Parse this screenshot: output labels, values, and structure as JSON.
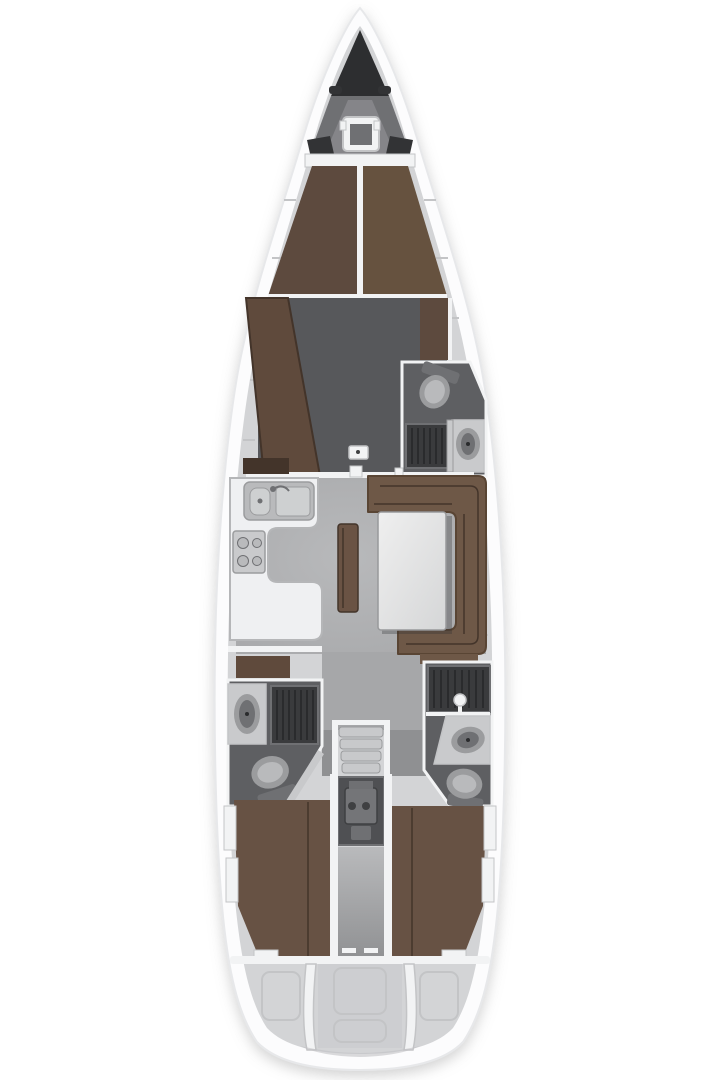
{
  "diagram": {
    "kind": "sailing-yacht-interior-floorplan",
    "orientation": "bow-up"
  },
  "colors": {
    "background": "#ffffff",
    "hull": "#fcfcfd",
    "hull_edge": "#e7e8ea",
    "liner": "#d3d4d6",
    "wall": "#f2f3f4",
    "wall_edge": "#c3c4c6",
    "anchor_locker": "#2d2e30",
    "foredeck": "#6f7073",
    "foredeck_light": "#97989b",
    "dark_locker": "#323335",
    "berth_brown": "#5d4a3e",
    "berth_brown_light": "#66523f",
    "chaise_brown": "#5f4a3c",
    "trim_brown": "#43342a",
    "sofa_brown": "#6e5847",
    "sofa_brown_dark": "#594534",
    "bench_brown": "#6a5344",
    "aft_berth_brown": "#675244",
    "floor_dark": "#57585b",
    "floor_mid": "#8f9092",
    "salon_floor": "#a6a7a9",
    "salon_floor_light": "#b8b9bb",
    "head_floor": "#5e5f62",
    "grate_dark": "#3a3b3d",
    "grate_line": "#2a2b2d",
    "fixture_lighter": "#b9babc",
    "fixture_light": "#c9cacc",
    "fixture_mid": "#9b9c9e",
    "fixture_dark": "#6f7073",
    "counter": "#eff0f2",
    "counter_edge": "#b5b6b8",
    "sink_steel": "#ced0d1",
    "table_edge": "#98999b",
    "table_light": "#efefef",
    "table_dark": "#d5d6d7",
    "stairs": "#c8c9cb",
    "stairs_edge": "#9a9b9d",
    "engine_bg": "#4f5053",
    "engine_part": "#747578",
    "engine_dark": "#3f4042",
    "stern_inner": "#cbccce",
    "stern_shade": "#c1c2c4",
    "shadow": "#2e2f31"
  },
  "components": {
    "bow": [
      "anchor-locker",
      "bow-cleats",
      "anchor-windlass"
    ],
    "forward_cabin": [
      "v-berth",
      "chaise-seat",
      "wardrobe",
      "floor-hatch"
    ],
    "forward_head": [
      "toilet",
      "shower-grate",
      "washbasin",
      "door"
    ],
    "salon": [
      "galley-counter",
      "double-sink",
      "stove",
      "dinette-sofa",
      "saloon-table",
      "bench-seat"
    ],
    "midship": [
      "companionway-stairs",
      "engine-compartment",
      "port-aft-head",
      "starboard-aft-head"
    ],
    "aft": [
      "port-aft-cabin-berth",
      "starboard-aft-cabin-berth",
      "stern-platform"
    ]
  }
}
